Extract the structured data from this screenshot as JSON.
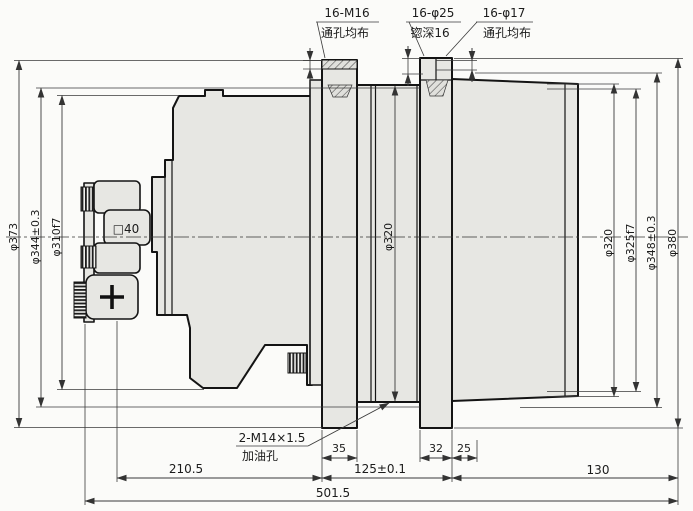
{
  "drawing": {
    "callouts": {
      "m16": {
        "spec": "16-M16",
        "note": "通孔均布"
      },
      "cbore": {
        "spec": "16-φ25",
        "note": "锪深16"
      },
      "d17": {
        "spec": "16-φ17",
        "note": "通孔均布"
      },
      "oil": {
        "spec": "2-M14×1.5",
        "note": "加油孔"
      }
    },
    "left_dims": {
      "d1": "φ373",
      "d2": "φ344±0.3",
      "d3": "φ310f7"
    },
    "mid_dim": "φ320",
    "right_dims": {
      "d1": "φ320",
      "d2": "φ325f7",
      "d3": "φ348±0.3",
      "d4": "φ380"
    },
    "shaft_label": "□40",
    "width_dims": {
      "w1": "35",
      "w2": "32",
      "w3": "25"
    },
    "length_dims": {
      "l1": "210.5",
      "l2": "125±0.1",
      "l3": "130"
    },
    "overall": "501.5"
  },
  "colors": {
    "background": "#fbfbf9",
    "part_fill": "#e7e7e3",
    "outline": "#141414",
    "dim": "#333333"
  }
}
